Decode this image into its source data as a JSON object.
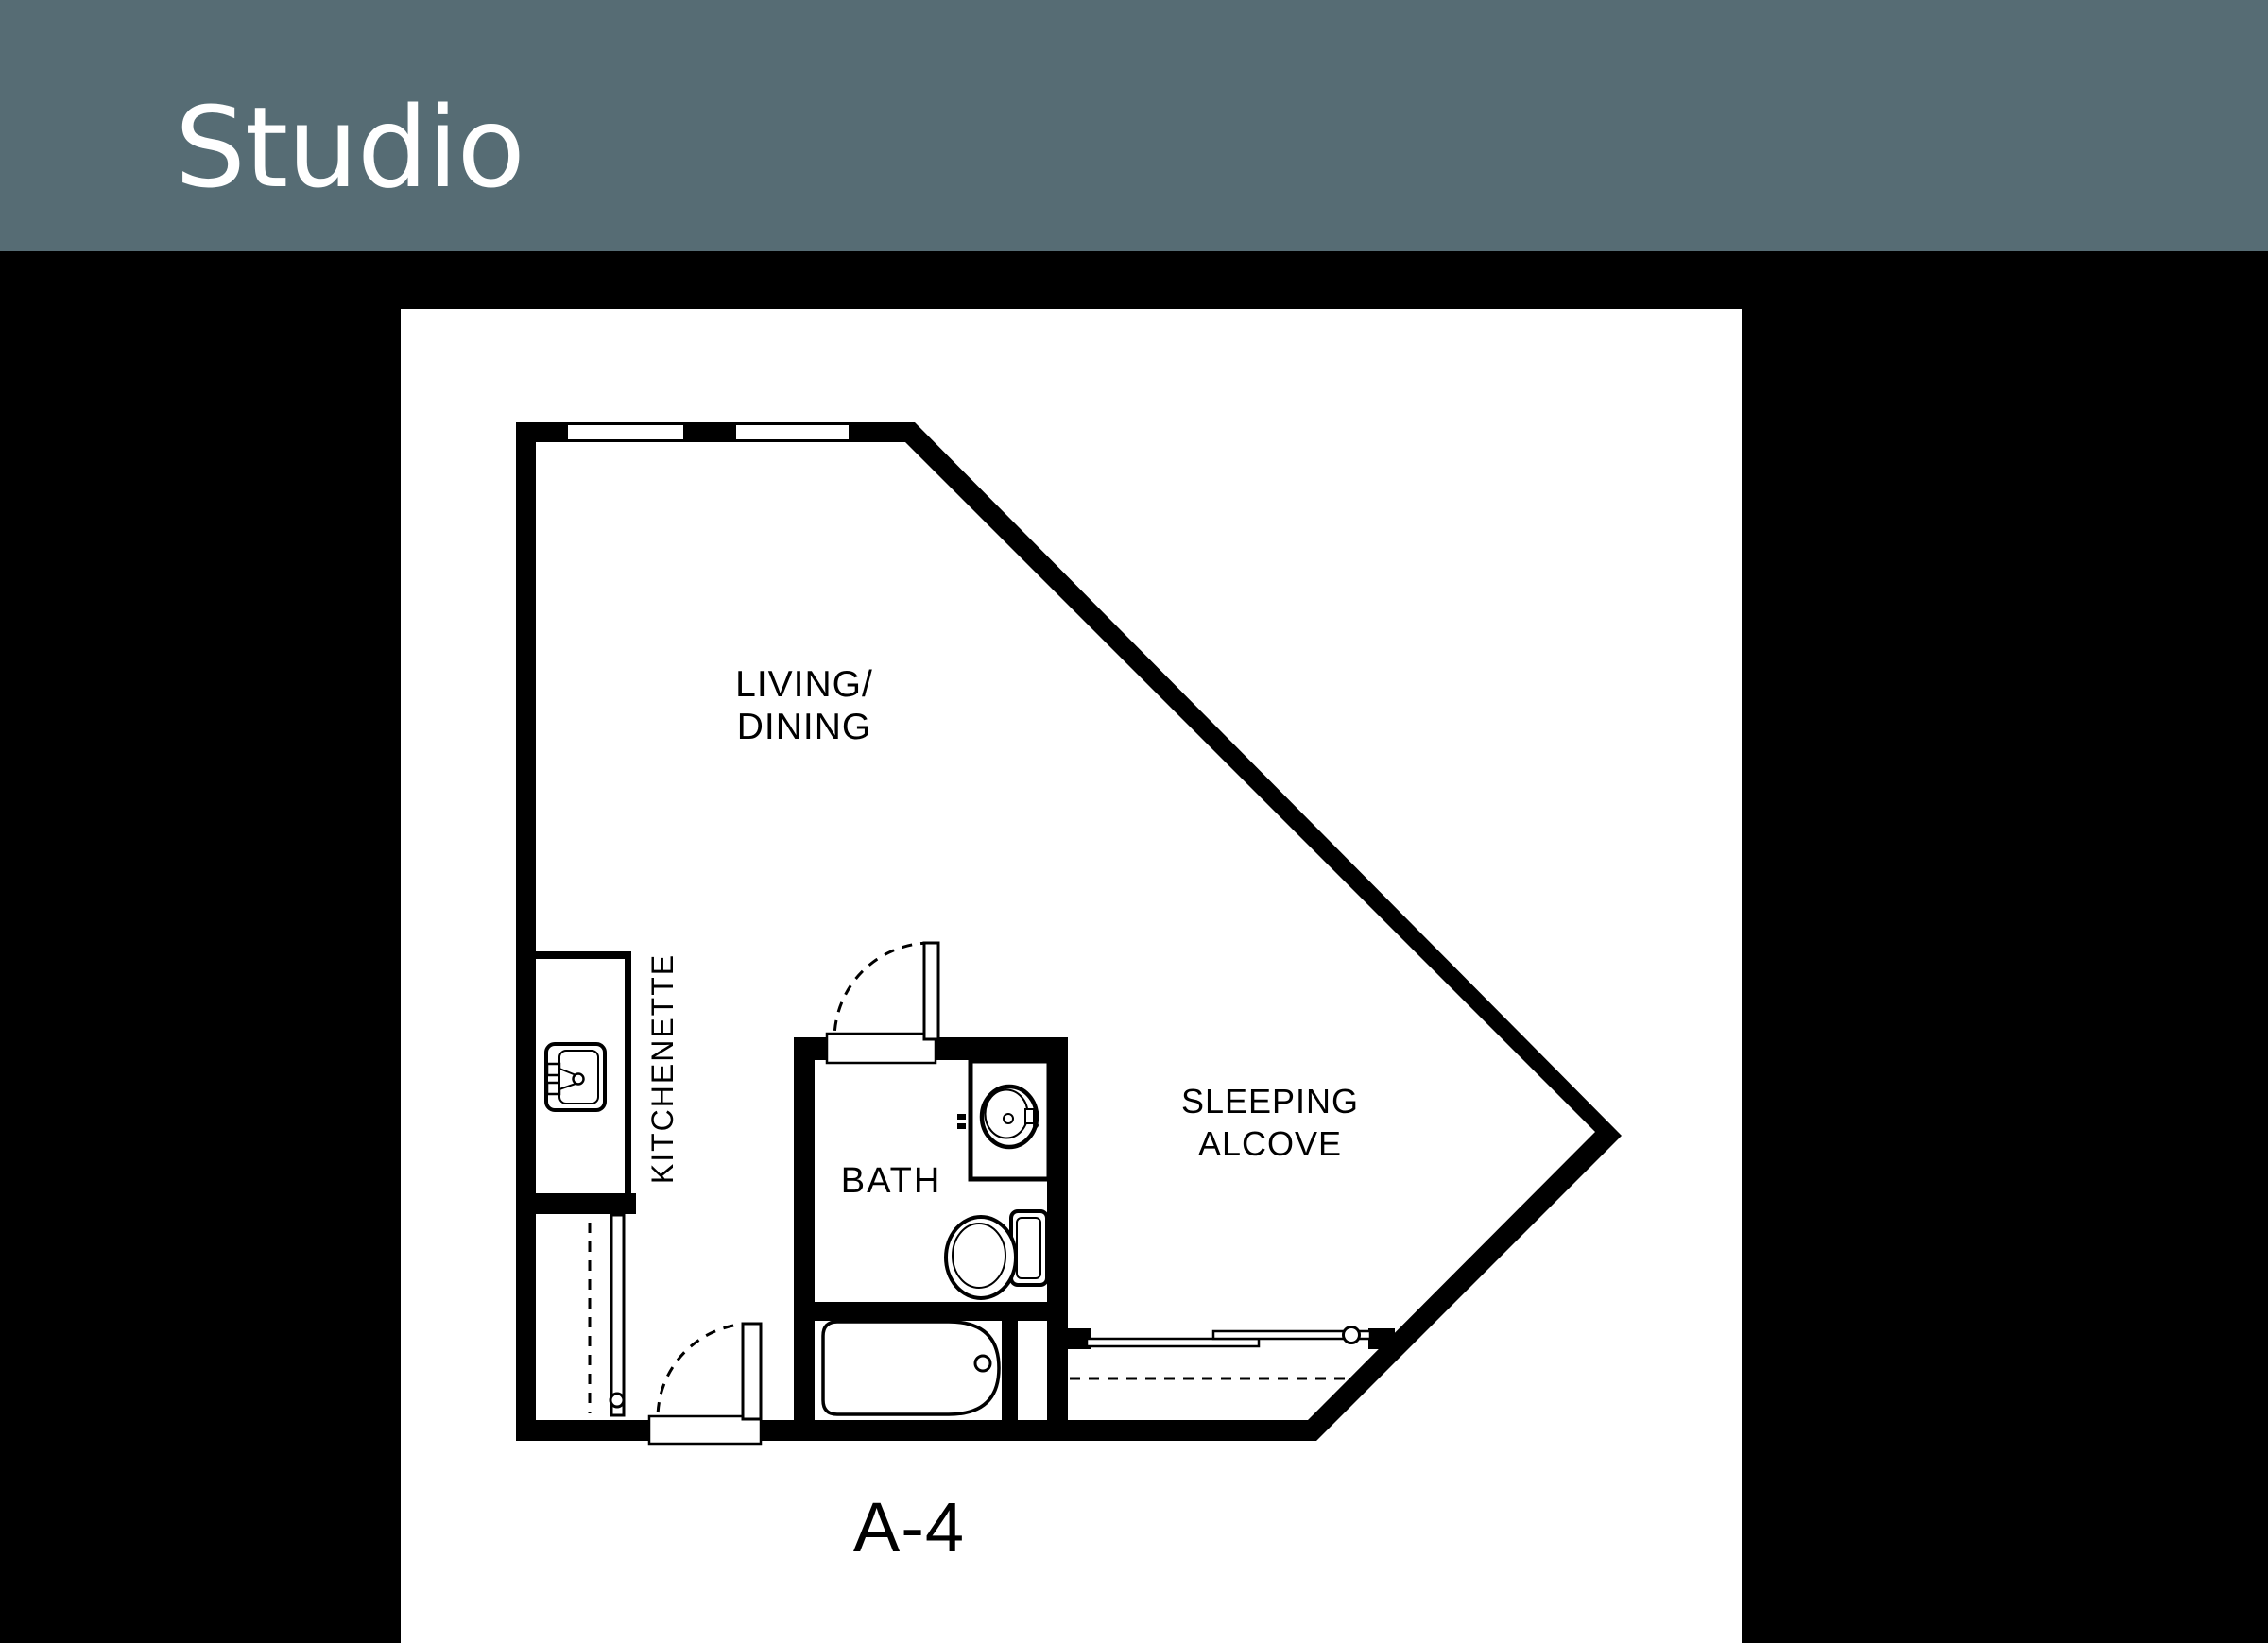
{
  "header": {
    "title": "Studio",
    "background_color": "#566c74",
    "text_color": "#ffffff"
  },
  "canvas": {
    "background_color": "#000000",
    "panel_background": "#ffffff",
    "line_color": "#000000"
  },
  "floorplan": {
    "unit_label": "A-4",
    "labels": {
      "living": {
        "line1": "LIVING/",
        "line2": "DINING"
      },
      "kitchenette": "KITCHENETTE",
      "bath": "BATH",
      "alcove": {
        "line1": "SLEEPING",
        "line2": "ALCOVE"
      }
    }
  }
}
